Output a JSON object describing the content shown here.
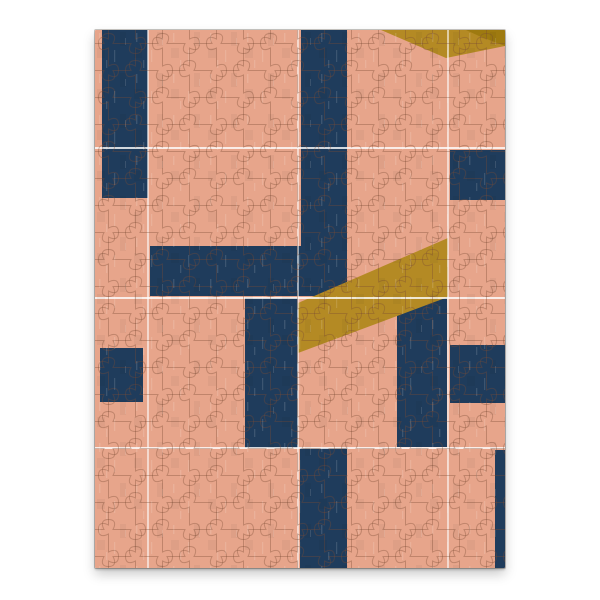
{
  "scene": {
    "type": "product-photo",
    "description": "Completed jigsaw puzzle with an abstract geometric pattern: navy blue bars and mustard diagonal ribbons over a salmon-pink background, divided by thin white panel seam lines, photographed flat on a white backdrop with a soft drop shadow",
    "background_color": "#ffffff"
  },
  "puzzle": {
    "frame": {
      "left": 95,
      "top": 30,
      "width": 410,
      "height": 538
    },
    "piece_size": 27,
    "colors": {
      "base": "#e7a58b",
      "navy": "#1f3c5c",
      "gold": "#b48a24",
      "gold_dark": "#9e7a10",
      "outline": "#7a4a33",
      "seam": "#ffffff"
    },
    "seams": {
      "vertical_x": [
        53,
        203,
        353
      ],
      "horizontal_y": [
        118,
        268,
        418
      ]
    },
    "shapes": [
      {
        "name": "navy-bar-top-left",
        "type": "rect",
        "color": "navy",
        "x": 7,
        "y": 0,
        "w": 46,
        "h": 168
      },
      {
        "name": "navy-bar-top-center",
        "type": "rect",
        "color": "navy",
        "x": 206,
        "y": 0,
        "w": 46,
        "h": 266
      },
      {
        "name": "navy-bar-horizontal-left",
        "type": "rect",
        "color": "navy",
        "x": 55,
        "y": 216,
        "w": 197,
        "h": 50
      },
      {
        "name": "navy-block-right-upper",
        "type": "rect",
        "color": "navy",
        "x": 355,
        "y": 120,
        "w": 55,
        "h": 50
      },
      {
        "name": "navy-square-left",
        "type": "rect",
        "color": "navy",
        "x": 5,
        "y": 318,
        "w": 43,
        "h": 54
      },
      {
        "name": "navy-bar-center",
        "type": "rect",
        "color": "navy",
        "x": 150,
        "y": 268,
        "w": 53,
        "h": 150
      },
      {
        "name": "navy-bar-center-right",
        "type": "rect",
        "color": "navy",
        "x": 302,
        "y": 260,
        "w": 50,
        "h": 157
      },
      {
        "name": "navy-block-right-lower",
        "type": "rect",
        "color": "navy",
        "x": 355,
        "y": 315,
        "w": 55,
        "h": 58
      },
      {
        "name": "navy-bar-bottom",
        "type": "rect",
        "color": "navy",
        "x": 205,
        "y": 418,
        "w": 47,
        "h": 120
      },
      {
        "name": "navy-sliver-bottom-right",
        "type": "rect",
        "color": "navy",
        "x": 400,
        "y": 420,
        "w": 10,
        "h": 118
      },
      {
        "name": "gold-ribbon-diagonal",
        "type": "polygon",
        "color": "gold",
        "points": [
          [
            353,
            208
          ],
          [
            353,
            267
          ],
          [
            203,
            323
          ],
          [
            203,
            273
          ]
        ]
      },
      {
        "name": "gold-chevron-top",
        "type": "polygon",
        "color": "gold",
        "points": [
          [
            286,
            0
          ],
          [
            351,
            28
          ],
          [
            410,
            16
          ],
          [
            410,
            0
          ]
        ]
      },
      {
        "name": "gold-chevron-top-dark",
        "type": "polygon",
        "color": "gold_dark",
        "points": [
          [
            371,
            0
          ],
          [
            410,
            0
          ],
          [
            410,
            16
          ],
          [
            384,
            6
          ]
        ]
      }
    ]
  }
}
